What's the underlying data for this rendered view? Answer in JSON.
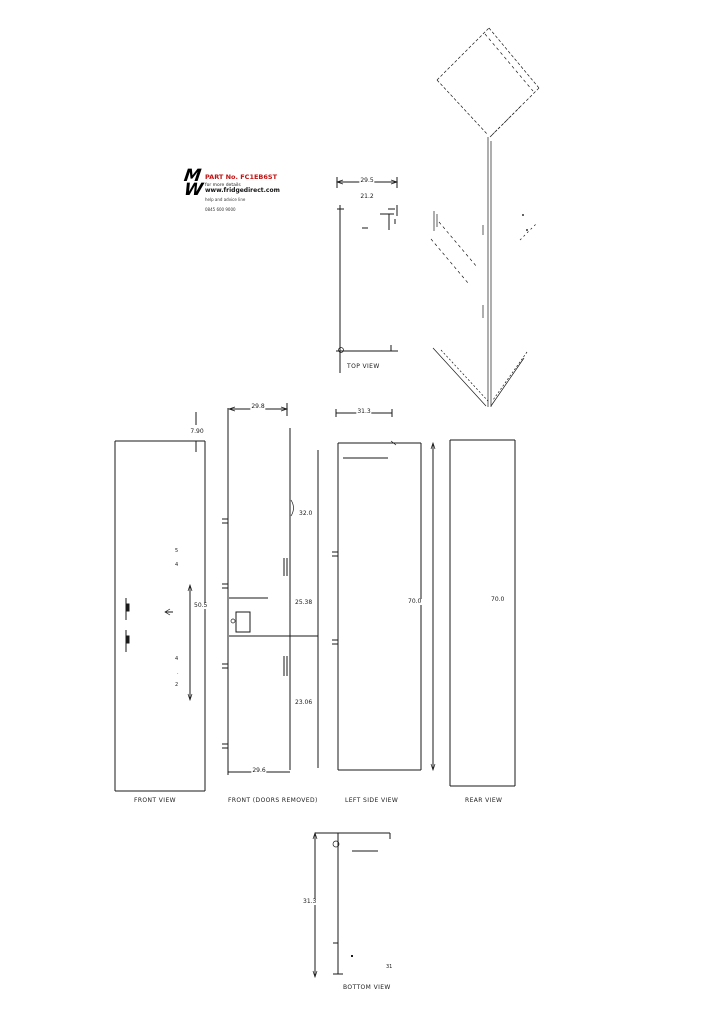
{
  "page": {
    "background": "#ffffff",
    "line_color": "#1a1a1a",
    "accent_red": "#c11212"
  },
  "logo": {
    "monogram_top": "M",
    "monogram_bottom": "W",
    "part_no": "PART No. FC1EB6ST",
    "tagline1": "for more details",
    "website": "www.fridgedirect.com",
    "tagline2": "help and advice line",
    "phone": "0845 600 9000"
  },
  "views": {
    "top": {
      "title": "TOP VIEW",
      "dim_width": "29.5",
      "dim_inner_width": "21.2"
    },
    "front": {
      "title": "FRONT VIEW",
      "dim_top": "7.90",
      "dim_height": "50.5",
      "micro_upper_1": "5",
      "micro_upper_2": "4",
      "micro_lower_1": "4",
      "micro_lower_2": ".",
      "micro_lower_3": "2"
    },
    "doors_removed": {
      "title": "FRONT (DOORS REMOVED)",
      "dim_width_top": "29.8",
      "dim_right_upper": "32.0",
      "dim_right_middle": "25.38",
      "dim_right_lower": "23.06",
      "dim_width_bottom": "29.6"
    },
    "left_side": {
      "title": "LEFT SIDE VIEW",
      "dim_depth": "31.3",
      "dim_height": "70.0"
    },
    "rear": {
      "title": "REAR VIEW",
      "dim_height": "70.0"
    },
    "bottom": {
      "title": "BOTTOM VIEW",
      "dim_depth": "31.3",
      "dim_note": "31"
    }
  }
}
